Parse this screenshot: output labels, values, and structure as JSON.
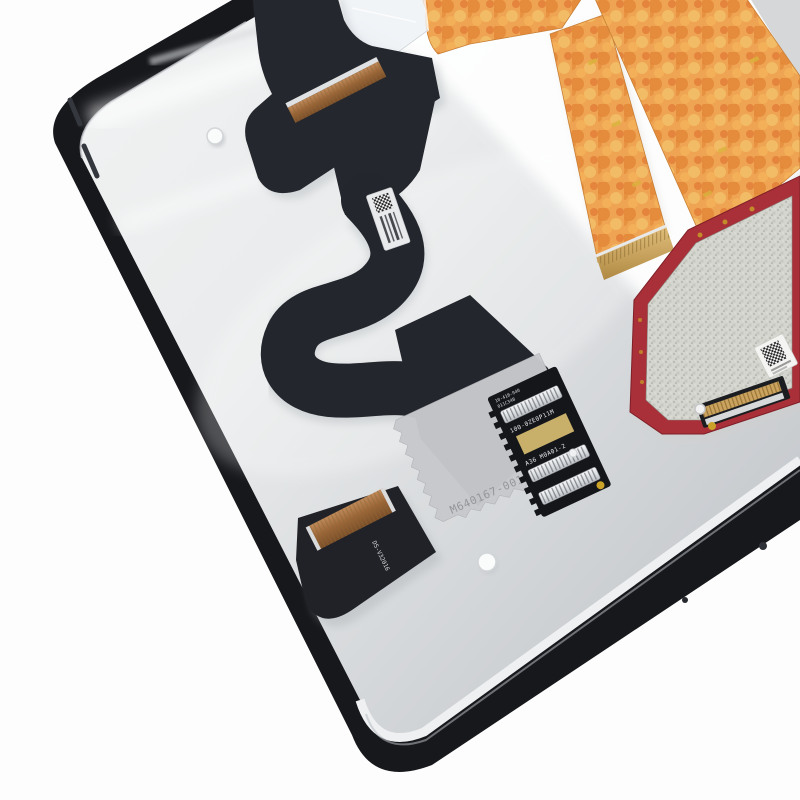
{
  "scene": {
    "type": "product-photo",
    "subject": "Tablet LCD display assembly, rear view with flex cables and driver PCB",
    "background_color": "#ffffff"
  },
  "panel": {
    "bezel_color": "#17181c",
    "back_color_light": "#f2f3f4",
    "back_color_dark": "#c3c6ca",
    "back_marking": "M640167-001"
  },
  "main_flex": {
    "color": "#25272e",
    "label_type": "qr-and-barcode-label",
    "label_bg": "#e9eaec"
  },
  "connector_board": {
    "color": "#15161a",
    "microtext_line1": "10-41B-040",
    "microtext_line2": "011C34B",
    "marking_line1": "100-0ZE0P11M",
    "marking_line2": "A36 M0A01-2",
    "pad_color": "#c9b06a",
    "connector_strip_count": 3
  },
  "tail_flex": {
    "marking": "DS-V32016",
    "connector_color": "#9a6a42"
  },
  "orange_cables": {
    "count": 2,
    "base_color": "#eca14d",
    "mottle_color": "#e07a33"
  },
  "driver_pcb": {
    "color": "#a93038",
    "shield_color": "#d2d3cc",
    "label_type": "qr-label",
    "connector_color": "#cba35f"
  }
}
